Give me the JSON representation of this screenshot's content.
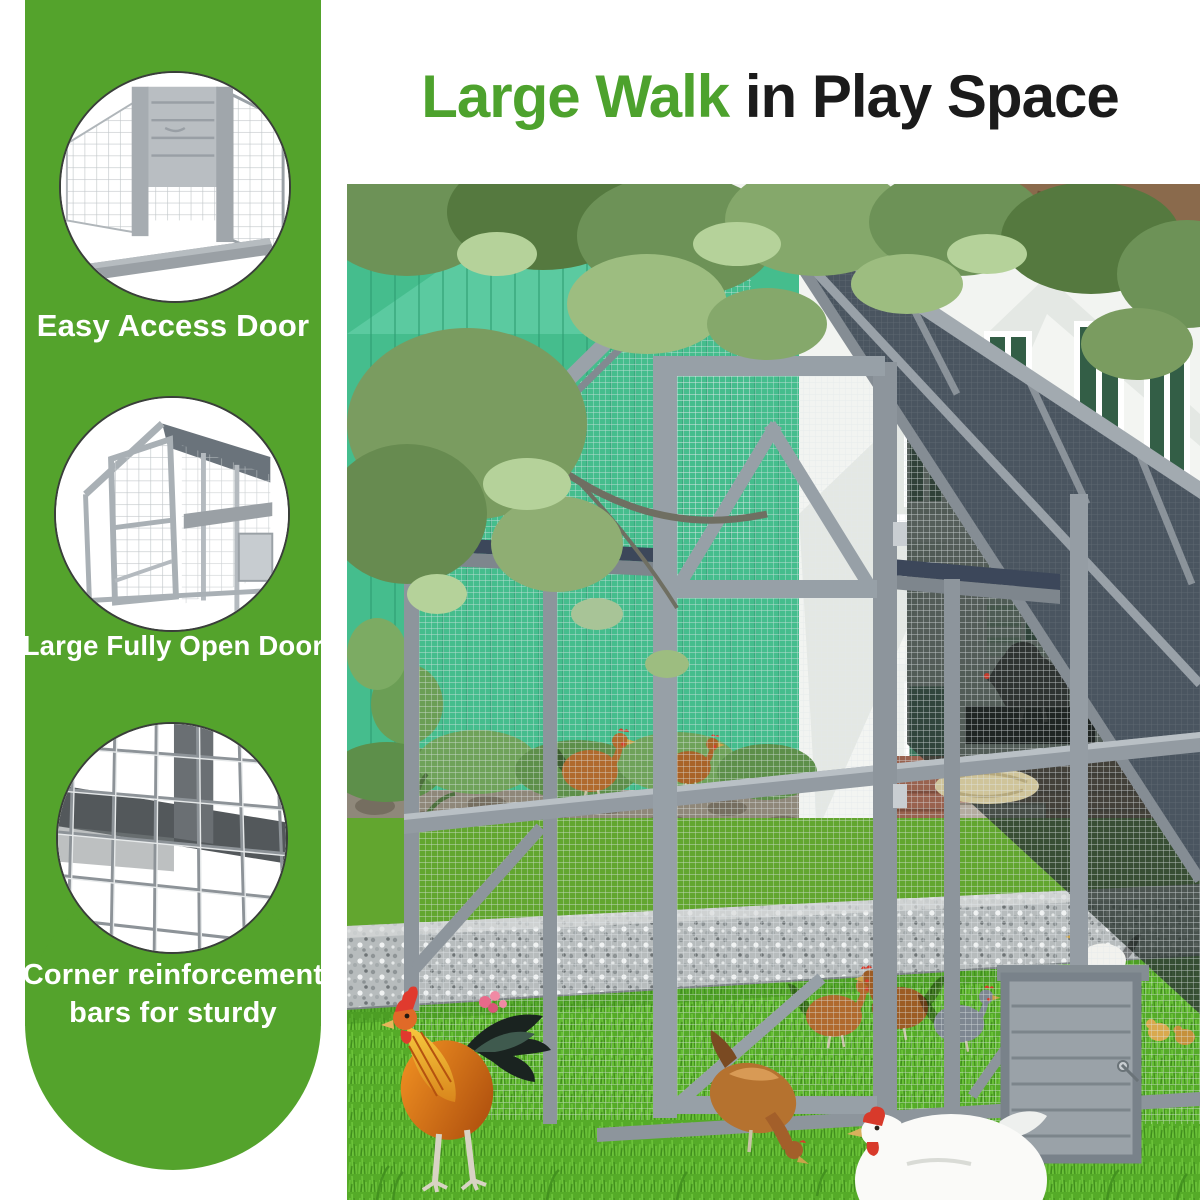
{
  "title": {
    "highlight": "Large Walk",
    "rest": "in Play Space"
  },
  "sidebar": {
    "callouts": [
      {
        "caption": "Easy Access Door"
      },
      {
        "caption": "Large Fully Open Door"
      },
      {
        "caption_line1": "Corner reinforcement",
        "caption_line2": "bars for sturdy"
      }
    ]
  },
  "theme": {
    "sidebar_green": "#54a32c",
    "title_green": "#4da22d",
    "title_dark": "#1b1b1b",
    "caption_white": "#ffffff",
    "barn_green": "#45bd8d",
    "grass_green": "#55ab28",
    "wood_gray": "#9199a0",
    "roof_dark": "#4a5560"
  }
}
